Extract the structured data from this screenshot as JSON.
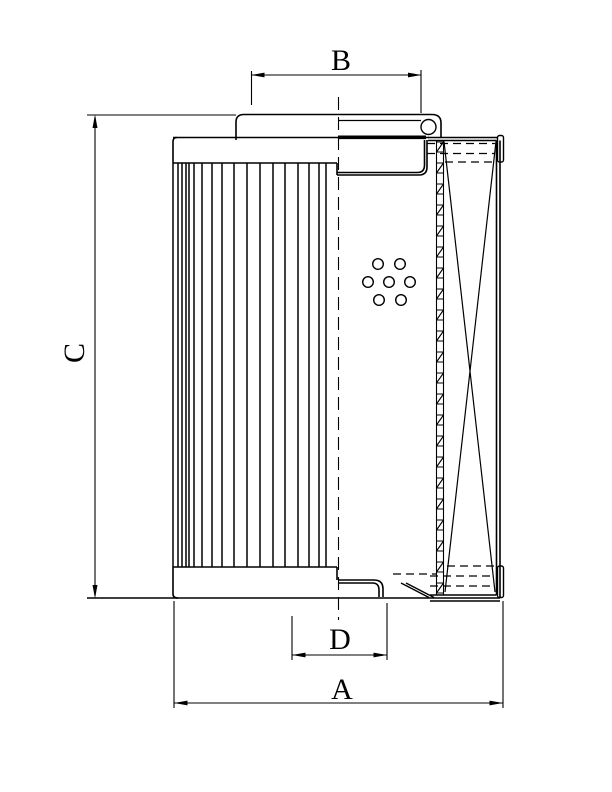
{
  "figure": {
    "type": "technical-drawing",
    "subject": "filter element half-section drawing",
    "background_color": "#ffffff",
    "line_color": "#000000",
    "dimension_labels": {
      "top_diameter": "B",
      "height": "C",
      "spigot_diameter": "D",
      "outer_diameter": "A"
    }
  }
}
